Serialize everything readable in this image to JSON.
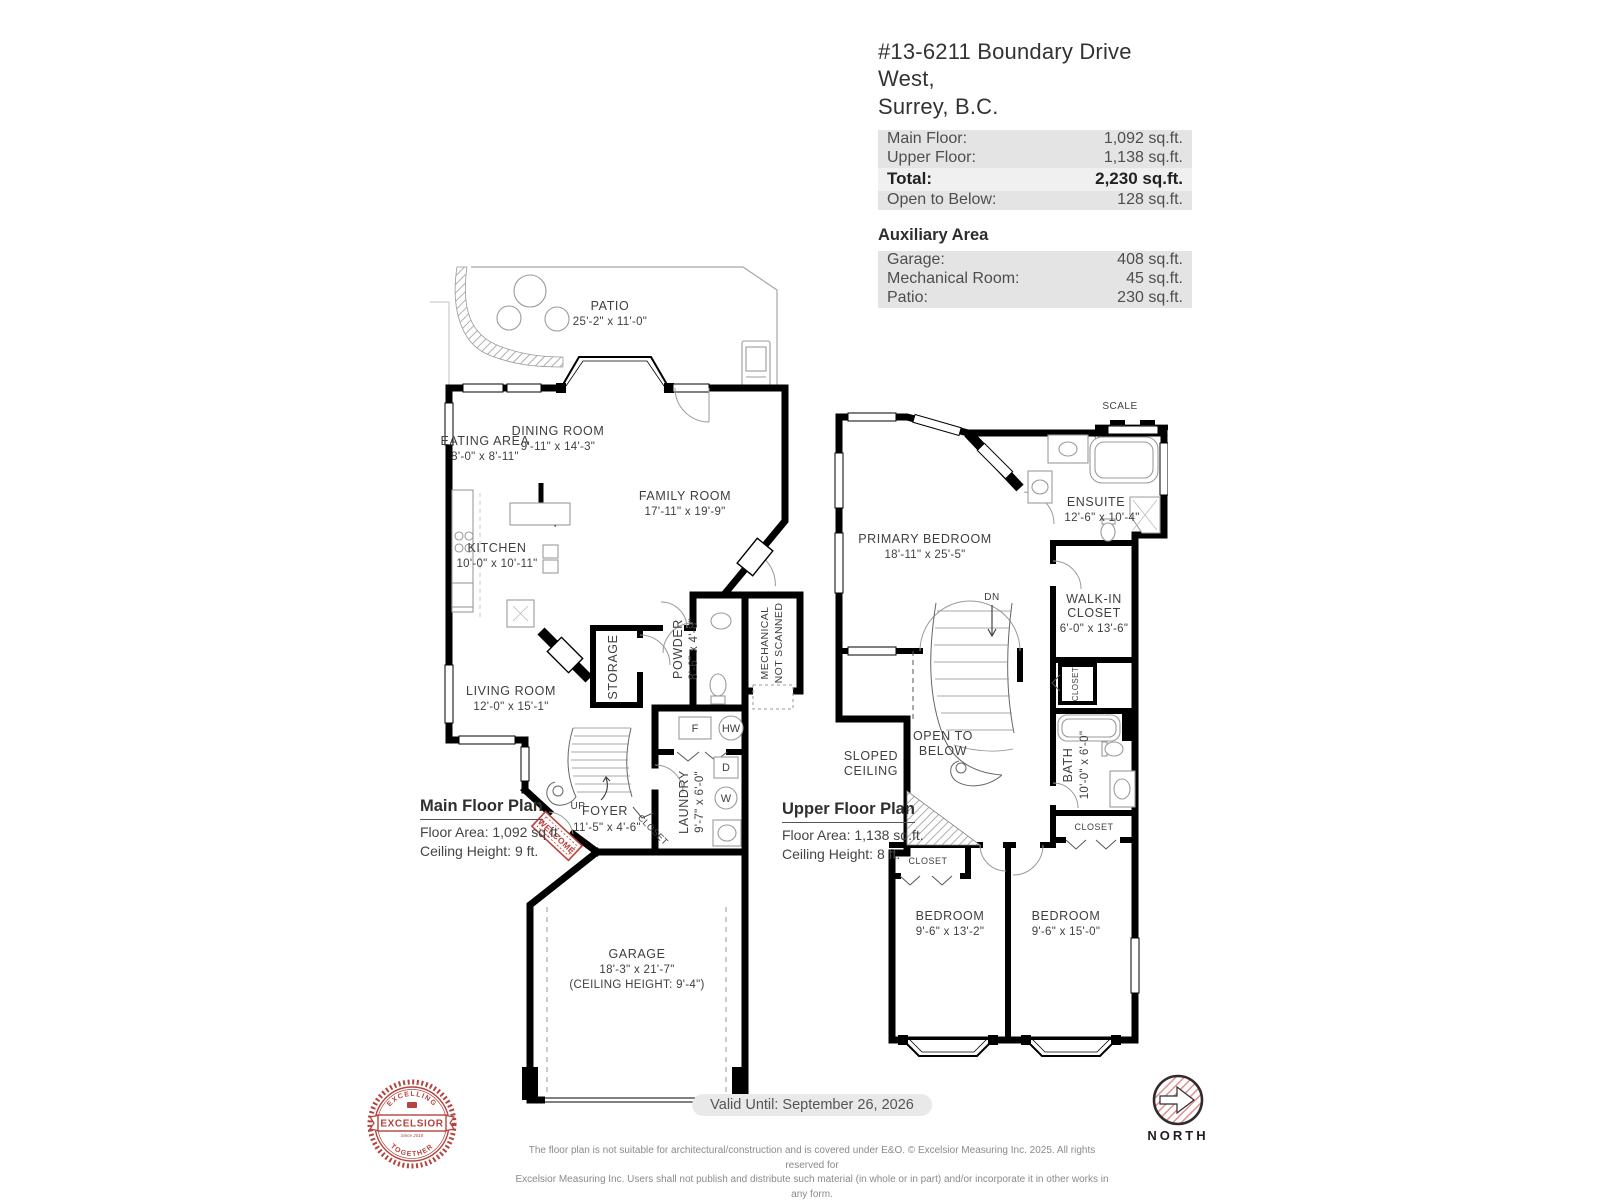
{
  "header": {
    "title_line1": "#13-6211 Boundary Drive West,",
    "title_line2": "Surrey, B.C.",
    "area_rows": [
      {
        "label": "Main Floor:",
        "value": "1,092 sq.ft."
      },
      {
        "label": "Upper Floor:",
        "value": "1,138 sq.ft."
      },
      {
        "label": "Total:",
        "value": "2,230 sq.ft."
      },
      {
        "label": "Open to Below:",
        "value": "128 sq.ft."
      }
    ],
    "auxiliary_title": "Auxiliary Area",
    "auxiliary_rows": [
      {
        "label": "Garage:",
        "value": "408 sq.ft."
      },
      {
        "label": "Mechanical Room:",
        "value": "45 sq.ft."
      },
      {
        "label": "Patio:",
        "value": "230 sq.ft."
      }
    ]
  },
  "main_floor": {
    "plan_title": "Main Floor Plan",
    "floor_area": "Floor Area: 1,092 sq.ft.",
    "ceiling_height": "Ceiling Height: 9 ft.",
    "rooms": {
      "patio": {
        "name": "PATIO",
        "dims": "25'-2\" x  11'-0\""
      },
      "eating_area": {
        "name": "EATING AREA",
        "dims": "8'-0\" x  8'-11\""
      },
      "dining_room": {
        "name": "DINING ROOM",
        "dims": "9'-11\" x 14'-3\""
      },
      "family_room": {
        "name": "FAMILY ROOM",
        "dims": "17'-11\" x 19'-9\""
      },
      "kitchen": {
        "name": "KITCHEN",
        "dims": "10'-0\" x 10'-11\""
      },
      "living_room": {
        "name": "LIVING ROOM",
        "dims": "12'-0\" x  15'-1\""
      },
      "storage": {
        "name": "STORAGE"
      },
      "powder": {
        "name": "POWDER",
        "dims": "8'-6\" x 4'-8\""
      },
      "mechanical": {
        "name": "MECHANICAL",
        "note": "NOT SCANNED"
      },
      "foyer": {
        "name": "FOYER",
        "dims": "11'-5\" x  4'-6\""
      },
      "laundry": {
        "name": "LAUNDRY",
        "dims": "9'-7\" x 6'-0\""
      },
      "closet": {
        "name": "CLOSET"
      },
      "garage": {
        "name": "GARAGE",
        "dims": "18'-3\" x  21'-7\"",
        "note": "(CEILING HEIGHT: 9'-4\")"
      }
    },
    "markers": {
      "up": "UP",
      "furnace": "F",
      "hot_water": "HW",
      "dryer": "D",
      "washer": "W",
      "welcome": "WELCOME"
    }
  },
  "upper_floor": {
    "plan_title": "Upper Floor Plan",
    "floor_area": "Floor Area: 1,138 sq.ft.",
    "ceiling_height": "Ceiling Height: 8 ft.",
    "scale": {
      "label": "SCALE",
      "min": "0'",
      "max": "5'"
    },
    "rooms": {
      "primary_bedroom": {
        "name": "PRIMARY BEDROOM",
        "dims": "18'-11\" x  25'-5\""
      },
      "ensuite": {
        "name": "ENSUITE",
        "dims": "12'-6\" x  10'-4\""
      },
      "walk_in_closet": {
        "line1": "WALK-IN",
        "line2": "CLOSET",
        "dims": "6'-0\" x  13'-6\""
      },
      "bath": {
        "name": "BATH",
        "dims": "10'-0\" x 6'-0\""
      },
      "bedroom_left": {
        "name": "BEDROOM",
        "dims": "9'-6\" x  13'-2\""
      },
      "bedroom_right": {
        "name": "BEDROOM",
        "dims": "9'-6\" x  15'-0\""
      },
      "open_to_below": {
        "line1": "OPEN TO",
        "line2": "BELOW"
      },
      "sloped_ceiling": {
        "line1": "SLOPED",
        "line2": "CEILING"
      },
      "closet": "CLOSET"
    },
    "markers": {
      "dn": "DN"
    }
  },
  "footer": {
    "valid_until": "Valid Until: September 26, 2026",
    "disclaimer_line1": "The floor plan is not suitable for architectural/construction and is covered under E&O. © Excelsior Measuring Inc. 2025. All rights reserved for",
    "disclaimer_line2": "Excelsior Measuring Inc. Users shall not publish and distribute such material (in whole or in part) and/or incorporate it in other works in any form."
  },
  "logos": {
    "excelsior": {
      "arc_top": "EXCELLING",
      "banner": "EXCELSIOR",
      "arc_bottom": "TOGETHER",
      "since": "Since 2018"
    },
    "north": "NORTH"
  },
  "colors": {
    "wall": "#000000",
    "label_text": "#3d3d3d",
    "accent_red": "#c0403a",
    "row_bg": "#e4e4e4",
    "total_row_bg": "#f0f0f0"
  }
}
